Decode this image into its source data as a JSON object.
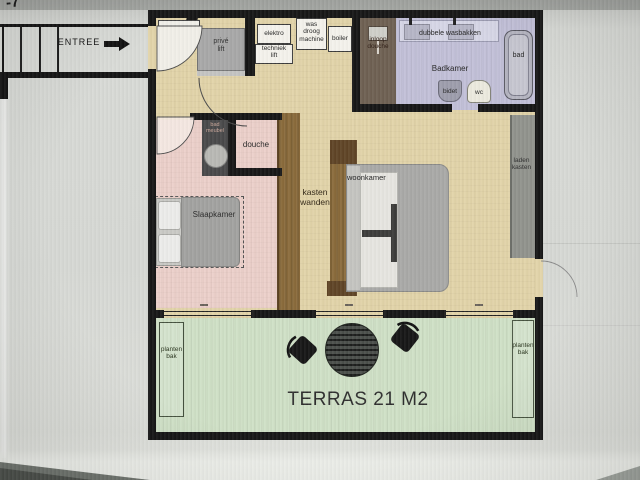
{
  "photo": {
    "handwritten_mark": "-7"
  },
  "entree": {
    "label": "ENTREE"
  },
  "upper_rooms": {
    "prive_lift": "privé\nlift",
    "elektro": "elektro",
    "techniek_lift": "techniek\nlift",
    "was_droog_machine": "was\ndroog\nmachine",
    "boiler": "boiler"
  },
  "bathroom": {
    "inloop_douche": "inloop\ndouche",
    "dubbele_wasbakken": "dubbele wasbakken",
    "badkamer": "Badkamer",
    "bad": "bad",
    "bidet": "bidet",
    "wc": "wc"
  },
  "bedroom": {
    "badmeubel": "bad\nmeubel",
    "douche": "douche",
    "slaapkamer": "Slaapkamer"
  },
  "living": {
    "kasten_wanden": "kasten\nwanden",
    "woonkamer": "woonkamer",
    "laden_kasten": "laden\nkasten"
  },
  "terrace": {
    "planten_bak_left": "planten\nbak",
    "planten_bak_right": "planten\nbak",
    "terras": "TERRAS 21 M2"
  },
  "colors": {
    "wall": "#161616",
    "floor_beige": "#e2d4a9",
    "bedroom_pink": "#ecd0ca",
    "bathroom_lavender": "#c2c0d8",
    "shower_brown": "#6e6052",
    "terrace_green": "#cfe0c6",
    "wardrobe_brown": "#8a6b3b",
    "furniture_gray": "#a9a9a7"
  }
}
